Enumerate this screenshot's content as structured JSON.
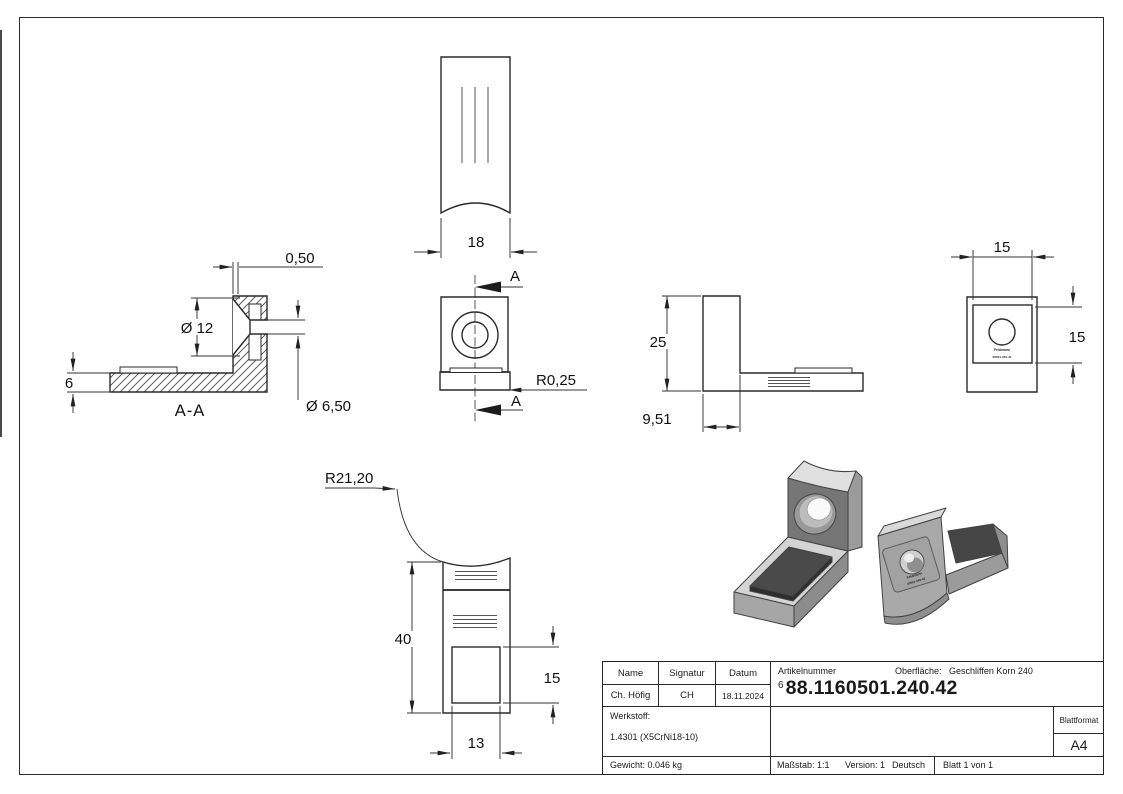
{
  "colors": {
    "line": "#2a2a2a",
    "dim_text": "#111111",
    "metal_light": "#dcdcdc",
    "metal_mid": "#a8a8a8",
    "metal_dark": "#767676",
    "pad": "#464646"
  },
  "views": {
    "section_aa": {
      "label": "A-A",
      "dim_lip": "0,50",
      "dim_countersink": "Ø 12",
      "dim_base_thickness": "6",
      "dim_hole": "Ø 6,50"
    },
    "top": {
      "dim_width": "18"
    },
    "front": {
      "section_mark_top": "A",
      "section_mark_bottom": "A",
      "dim_corner_radius": "R0,25"
    },
    "side": {
      "dim_height": "25",
      "dim_leg": "9,51"
    },
    "back": {
      "dim_sticker_width": "15",
      "dim_sticker_height": "15",
      "sticker_line1": "Feldmann",
      "sticker_line2": "60501-240-42"
    },
    "bottom": {
      "dim_saddle_radius": "R21,20",
      "dim_length": "40",
      "dim_pad_height": "15",
      "dim_pad_width": "13"
    }
  },
  "title_block": {
    "col_name": "Name",
    "col_signatur": "Signatur",
    "col_datum": "Datum",
    "val_name": "Ch. Höfig",
    "val_signatur": "CH",
    "val_datum": "18.11.2024",
    "artikelnummer_label": "Artikelnummer",
    "artikelnummer_prefix": "6",
    "artikelnummer": "88.1160501.240.42",
    "oberflaeche_label": "Oberfläche:",
    "oberflaeche_value": "Geschliffen Korn 240",
    "werkstoff_label": "Werkstoff:",
    "werkstoff_value": "1.4301 (X5CrNi18-10)",
    "blattformat_label": "Blattformat",
    "blattformat_value": "A4",
    "gewicht": "Gewicht: 0.046 kg",
    "massstab": "Maßstab: 1:1",
    "version": "Version: 1",
    "sprache": "Deutsch",
    "blatt": "Blatt 1 von 1"
  }
}
